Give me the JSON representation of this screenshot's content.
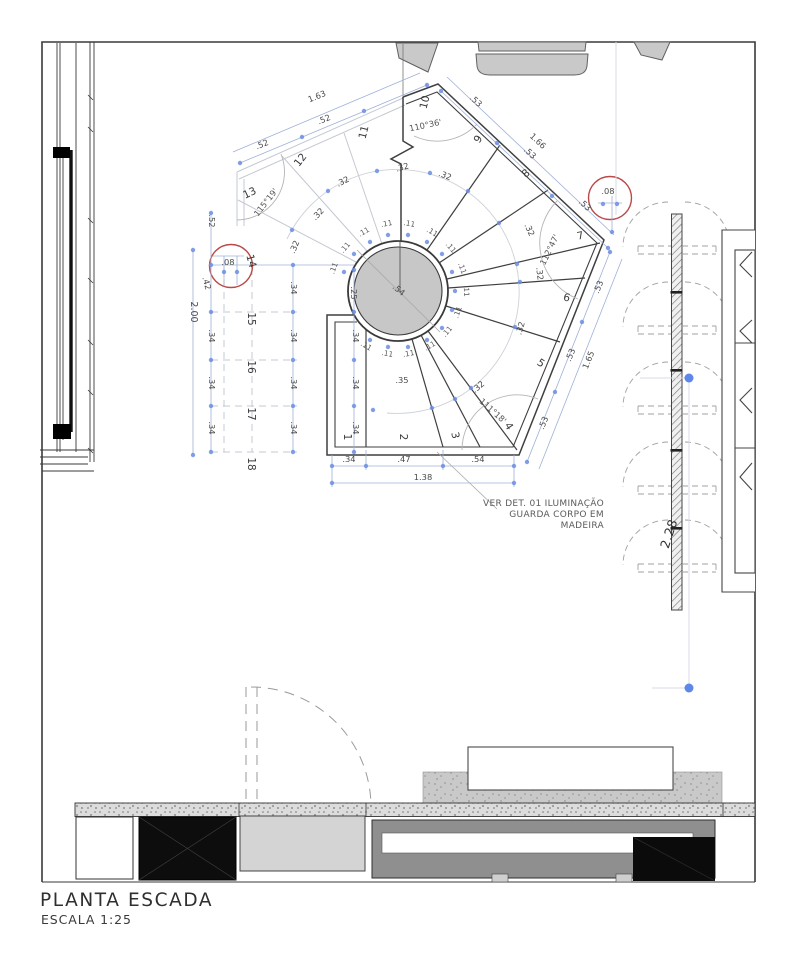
{
  "title": {
    "main": "PLANTA ESCADA",
    "scale": "ESCALA 1:25"
  },
  "note": {
    "line1": "VER DET. 01 ILUMINAÇÃO",
    "line2": "GUARDA CORPO EM",
    "line3": "MADEIRA"
  },
  "colors": {
    "detail_marker": "#b94a48",
    "dimension_blue": "#6b8de3",
    "ink": "#3a3a3a"
  },
  "plan": {
    "labels": [
      [
        "1",
        344,
        437,
        90,
        "step"
      ],
      [
        "2",
        400,
        437,
        90,
        "step"
      ],
      [
        "3",
        452,
        436,
        78,
        "step"
      ],
      [
        "4",
        506,
        428,
        58,
        "step"
      ],
      [
        "5",
        539,
        366,
        33,
        "step"
      ],
      [
        "6",
        566,
        301,
        12,
        "step"
      ],
      [
        "7",
        581,
        239,
        -12,
        "step"
      ],
      [
        "8",
        528,
        176,
        -40,
        "step"
      ],
      [
        "9",
        481,
        141,
        -57,
        "step"
      ],
      [
        "10",
        428,
        103,
        -76,
        "step"
      ],
      [
        "11",
        367,
        133,
        -76,
        "step"
      ],
      [
        "12",
        303,
        162,
        -52,
        "step"
      ],
      [
        "13",
        251,
        196,
        -25,
        "step"
      ],
      [
        "14",
        248,
        262,
        75,
        "step"
      ],
      [
        "15",
        248,
        319,
        90,
        "step"
      ],
      [
        "16",
        248,
        367,
        90,
        "step"
      ],
      [
        "17",
        248,
        414,
        90,
        "step"
      ],
      [
        "18",
        248,
        464,
        90,
        "step"
      ],
      [
        "110°36'",
        426,
        128,
        -12,
        "ang"
      ],
      [
        "112°47'",
        552,
        251,
        -64,
        "ang"
      ],
      [
        "111°18'",
        491,
        413,
        42,
        "ang"
      ],
      [
        "115°19'",
        268,
        204,
        -52,
        "ang"
      ],
      [
        ".54",
        397,
        292,
        40,
        "dim"
      ],
      [
        ".08",
        228,
        265,
        0,
        "dim"
      ],
      [
        ".08",
        608,
        194,
        0,
        "dim"
      ],
      [
        ".52",
        263,
        147,
        -22,
        "dim"
      ],
      [
        ".52",
        325,
        122,
        -22,
        "dim"
      ],
      [
        "1.63",
        318,
        99,
        -22,
        "dim"
      ],
      [
        ".52",
        209,
        221,
        90,
        "dim"
      ],
      [
        ".53",
        474,
        103,
        43,
        "dim"
      ],
      [
        ".53",
        528,
        155,
        43,
        "dim"
      ],
      [
        ".53",
        583,
        207,
        43,
        "dim"
      ],
      [
        "1.66",
        536,
        143,
        43,
        "dim"
      ],
      [
        ".53",
        601,
        288,
        -68,
        "dim"
      ],
      [
        ".53",
        573,
        356,
        -68,
        "dim"
      ],
      [
        ".53",
        546,
        424,
        -68,
        "dim"
      ],
      [
        "1.65",
        591,
        361,
        -68,
        "dim"
      ],
      [
        ".34",
        349,
        462,
        0,
        "dim"
      ],
      [
        ".47",
        404,
        462,
        0,
        "dim"
      ],
      [
        ".54",
        478,
        462,
        0,
        "dim"
      ],
      [
        "1.38",
        423,
        480,
        0,
        "dim"
      ],
      [
        ".42",
        204,
        284,
        75,
        "dim"
      ],
      [
        ".34",
        209,
        336,
        90,
        "dim"
      ],
      [
        ".34",
        209,
        383,
        90,
        "dim"
      ],
      [
        ".34",
        209,
        428,
        90,
        "dim"
      ],
      [
        "2.00",
        191,
        312,
        90,
        "dimb"
      ],
      [
        ".34",
        291,
        288,
        90,
        "dim"
      ],
      [
        ".34",
        291,
        336,
        90,
        "dim"
      ],
      [
        ".34",
        291,
        383,
        90,
        "dim"
      ],
      [
        ".34",
        291,
        428,
        90,
        "dim"
      ],
      [
        ".25",
        351,
        293,
        90,
        "dim"
      ],
      [
        ".34",
        353,
        336,
        90,
        "dim"
      ],
      [
        ".34",
        353,
        383,
        90,
        "dim"
      ],
      [
        ".34",
        353,
        428,
        90,
        "dim"
      ],
      [
        ".35",
        402,
        383,
        0,
        "dim"
      ],
      [
        ".32",
        297,
        248,
        -67,
        "dim"
      ],
      [
        ".32",
        320,
        216,
        -46,
        "dim"
      ],
      [
        ".32",
        344,
        184,
        -27,
        "dim"
      ],
      [
        ".32",
        403,
        170,
        -15,
        "dim"
      ],
      [
        ".32",
        444,
        178,
        22,
        "dim"
      ],
      [
        ".32",
        527,
        231,
        65,
        "dim"
      ],
      [
        ".32",
        537,
        274,
        83,
        "dim"
      ],
      [
        ".32",
        523,
        329,
        -73,
        "dim"
      ],
      [
        ".32",
        480,
        389,
        -40,
        "dim"
      ],
      [
        ".11",
        336,
        269,
        -70,
        "s11"
      ],
      [
        ".11",
        347,
        249,
        -50,
        "s11"
      ],
      [
        ".11",
        365,
        234,
        -30,
        "s11"
      ],
      [
        ".11",
        387,
        226,
        -10,
        "s11"
      ],
      [
        ".11",
        409,
        226,
        10,
        "s11"
      ],
      [
        ".11",
        431,
        234,
        30,
        "s11"
      ],
      [
        ".11",
        449,
        249,
        50,
        "s11"
      ],
      [
        ".11",
        460,
        269,
        70,
        "s11"
      ],
      [
        ".11",
        464,
        291,
        88,
        "s11"
      ],
      [
        ".11",
        460,
        313,
        -70,
        "s11"
      ],
      [
        ".11",
        449,
        333,
        -50,
        "s11"
      ],
      [
        ".11",
        431,
        348,
        -30,
        "s11"
      ],
      [
        ".11",
        409,
        356,
        -10,
        "s11"
      ],
      [
        ".11",
        387,
        356,
        10,
        "s11"
      ],
      [
        ".11",
        365,
        348,
        30,
        "s11"
      ],
      [
        "2.28",
        673,
        535,
        -72,
        "wd"
      ]
    ],
    "dots": [
      [
        344,
        272
      ],
      [
        354,
        254
      ],
      [
        370,
        242
      ],
      [
        388,
        235
      ],
      [
        408,
        235
      ],
      [
        427,
        242
      ],
      [
        442,
        254
      ],
      [
        452,
        272
      ],
      [
        455,
        291
      ],
      [
        452,
        310
      ],
      [
        442,
        328
      ],
      [
        427,
        340
      ],
      [
        408,
        347
      ],
      [
        388,
        347
      ],
      [
        370,
        340
      ],
      [
        373,
        410
      ],
      [
        432,
        408
      ],
      [
        455,
        399
      ],
      [
        471,
        388
      ],
      [
        515,
        327
      ],
      [
        520,
        282
      ],
      [
        517,
        264
      ],
      [
        499,
        223
      ],
      [
        468,
        191
      ],
      [
        430,
        173
      ],
      [
        377,
        171
      ],
      [
        328,
        191
      ],
      [
        292,
        230
      ],
      [
        240,
        163
      ],
      [
        302,
        137
      ],
      [
        364,
        111
      ],
      [
        427,
        85
      ],
      [
        441,
        91
      ],
      [
        497,
        143
      ],
      [
        552,
        196
      ],
      [
        608,
        248
      ],
      [
        610,
        252
      ],
      [
        582,
        322
      ],
      [
        555,
        392
      ],
      [
        527,
        462
      ],
      [
        332,
        466
      ],
      [
        366,
        466
      ],
      [
        443,
        466
      ],
      [
        514,
        466
      ],
      [
        332,
        483
      ],
      [
        514,
        483
      ],
      [
        211,
        213
      ],
      [
        211,
        265
      ],
      [
        211,
        312
      ],
      [
        211,
        360
      ],
      [
        211,
        406
      ],
      [
        211,
        452
      ],
      [
        193,
        250
      ],
      [
        193,
        455
      ],
      [
        293,
        265
      ],
      [
        293,
        312
      ],
      [
        293,
        360
      ],
      [
        293,
        406
      ],
      [
        293,
        452
      ],
      [
        354,
        270
      ],
      [
        354,
        312
      ],
      [
        354,
        360
      ],
      [
        354,
        406
      ],
      [
        354,
        452
      ],
      [
        224,
        272
      ],
      [
        237,
        272
      ],
      [
        603,
        204
      ],
      [
        617,
        204
      ],
      [
        612,
        232
      ]
    ],
    "big_dots": [
      [
        689,
        378
      ],
      [
        689,
        688
      ]
    ],
    "dimlines": [
      [
        240,
        163,
        427,
        85
      ],
      [
        233,
        152,
        420,
        73
      ],
      [
        441,
        91,
        608,
        248
      ],
      [
        447,
        77,
        614,
        235
      ],
      [
        610,
        252,
        527,
        462
      ],
      [
        622,
        259,
        539,
        469
      ],
      [
        332,
        466,
        514,
        466
      ],
      [
        332,
        483,
        514,
        483
      ],
      [
        211,
        213,
        211,
        452
      ],
      [
        193,
        250,
        193,
        455
      ],
      [
        293,
        265,
        293,
        452
      ],
      [
        354,
        270,
        354,
        452
      ],
      [
        213,
        256,
        244,
        256
      ],
      [
        224,
        256,
        224,
        285
      ],
      [
        237,
        256,
        237,
        285
      ],
      [
        598,
        203,
        622,
        203
      ],
      [
        612,
        196,
        612,
        233
      ],
      [
        332,
        455,
        332,
        487
      ],
      [
        514,
        455,
        514,
        487
      ],
      [
        366,
        450,
        366,
        470
      ],
      [
        443,
        450,
        443,
        470
      ],
      [
        211,
        265,
        354,
        265
      ]
    ],
    "faintlines": [
      [
        689,
        382,
        689,
        686
      ],
      [
        640,
        378,
        686,
        378
      ],
      [
        652,
        688,
        686,
        688
      ],
      [
        616,
        42,
        616,
        215
      ]
    ]
  }
}
